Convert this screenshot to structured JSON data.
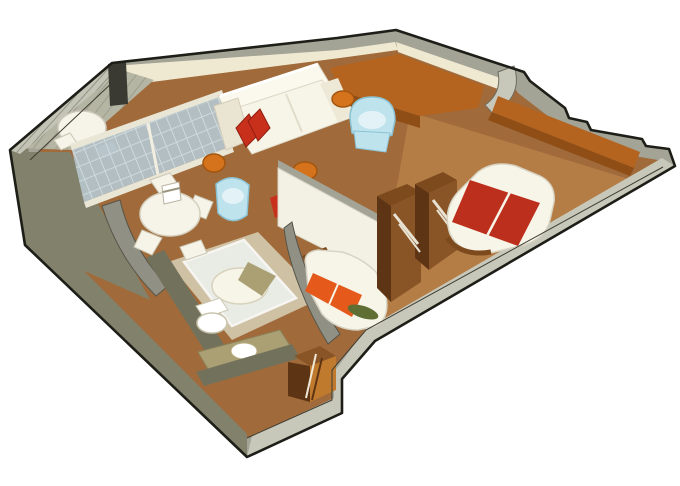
{
  "scene": {
    "description": "3D isometric cutaway floor plan of a ship stateroom suite",
    "rooms": [
      {
        "name": "balcony",
        "features": [
          "round-table",
          "balcony-chairs",
          "railing",
          "sliding-glass-doors"
        ]
      },
      {
        "name": "living-dining-room",
        "features": [
          "sofa",
          "red-pillows",
          "ottoman-stools",
          "blue-armchair",
          "blue-barrel-chair",
          "round-dining-table",
          "dining-chairs",
          "corner-desk"
        ]
      },
      {
        "name": "bathroom",
        "features": [
          "glass-shower",
          "toilet",
          "vanity-sink"
        ]
      },
      {
        "name": "middle-bedroom",
        "features": [
          "single-bed-orange-runner",
          "green-bolster",
          "wardrobe-closets"
        ]
      },
      {
        "name": "main-bedroom",
        "features": [
          "double-bed-red-runner",
          "long-wall-counter"
        ]
      },
      {
        "name": "entry-hall",
        "features": [
          "door-alcove"
        ]
      }
    ]
  },
  "colors": {
    "background": "#ffffff",
    "outline": "#1e1e18",
    "wall_top": "#a3a396",
    "wall_face_light": "#c8c8ba",
    "wall_face_dark": "#82826c",
    "wall_olive": "#72725c",
    "wall_cream": "#f0e9d1",
    "wall_white": "#f3f0e4",
    "curve_wall": "#909084",
    "railing": "#c4c4b6",
    "glass": "#b4c3c9",
    "glass_frame": "#eae6d6",
    "floor_main": "#a06a3a",
    "floor_bedroom": "#b57d46",
    "floor_balcony": "#b5b5a4",
    "floor_bath": "#cfc1a4",
    "counter": "#b4641f",
    "counter_front": "#8f4e16",
    "wood_dark": "#5e3514",
    "wood_mid": "#7d4a1e",
    "wood_light": "#8a5526",
    "bed_white": "#f7f4e8",
    "stripe_red": "#bd2f1d",
    "stripe_orange": "#e55a1a",
    "pillow_red": "#c9301b",
    "pillow_green": "#5f6f33",
    "stool": "#d4731c",
    "stool_rim": "#a4550f",
    "chair_blue": "#bee3ed",
    "chair_blue_light": "#e2f2f6",
    "chair_blue_dark": "#8cc3d4",
    "table_white": "#f6f3e8",
    "vanity": "#ab9f74",
    "alcove_floor": "#c07a2e"
  }
}
